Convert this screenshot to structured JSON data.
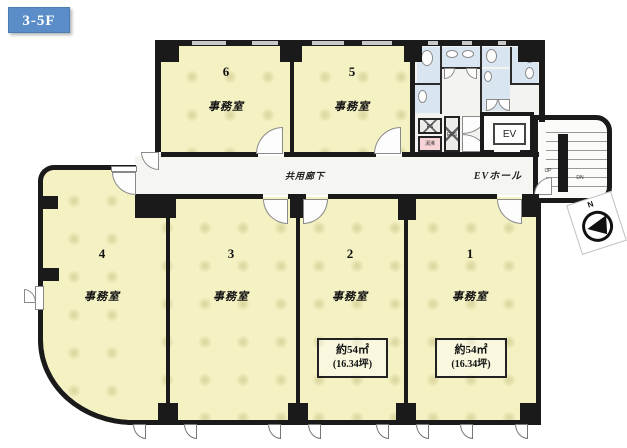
{
  "floor_badge": "3-5F",
  "rooms_upper": [
    {
      "number": "6",
      "label": "事務室"
    },
    {
      "number": "5",
      "label": "事務室"
    }
  ],
  "rooms_lower": [
    {
      "number": "4",
      "label": "事務室"
    },
    {
      "number": "3",
      "label": "事務室"
    },
    {
      "number": "2",
      "label": "事務室",
      "area_m2": "約54㎡",
      "area_tsubo": "(16.34坪)"
    },
    {
      "number": "1",
      "label": "事務室",
      "area_m2": "約54㎡",
      "area_tsubo": "(16.34坪)"
    }
  ],
  "corridor": {
    "label": "共用廊下"
  },
  "elevator": {
    "label": "EV"
  },
  "ev_hall": {
    "label": "EVホール"
  },
  "stairs": {
    "up_label": "UP",
    "down_label": "DN"
  },
  "compass": {
    "north_label": "N"
  },
  "utility": {
    "ps_label": "PS",
    "eps_label": "EPS",
    "kitchenette_label": "湯沸"
  },
  "colors": {
    "badge_blue": "#5b8ec8",
    "room_yellow": "#f4f1c3",
    "wet_area_blue": "#d9e6f1",
    "kitchenette_pink": "#f7d4d7",
    "wall_black": "#1a1a1a"
  }
}
